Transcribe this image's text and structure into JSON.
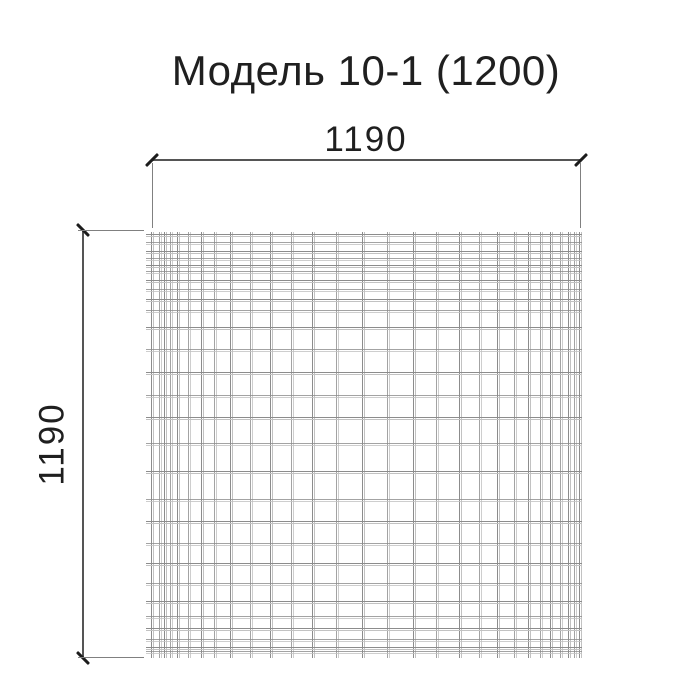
{
  "title": "Модель 10-1 (1200)",
  "dimensions": {
    "width": {
      "label": "1190"
    },
    "height": {
      "label": "1190"
    }
  },
  "mesh": {
    "vertical_wires": [
      0,
      0.018,
      0.03,
      0.044,
      0.06,
      0.086,
      0.116,
      0.148,
      0.185,
      0.231,
      0.278,
      0.326,
      0.377,
      0.433,
      0.493,
      0.551,
      0.611,
      0.667,
      0.72,
      0.766,
      0.808,
      0.847,
      0.88,
      0.91,
      0.933,
      0.956,
      0.975,
      0.988,
      1
    ],
    "horizontal_wires": [
      0,
      0.019,
      0.04,
      0.058,
      0.075,
      0.089,
      0.11,
      0.133,
      0.157,
      0.182,
      0.222,
      0.276,
      0.332,
      0.386,
      0.439,
      0.502,
      0.568,
      0.636,
      0.689,
      0.741,
      0.79,
      0.836,
      0.881,
      0.916,
      0.946,
      0.972,
      0.991,
      1
    ]
  },
  "colors": {
    "background": "#ffffff",
    "text": "#1f1f1f",
    "dimension_line": "#555555",
    "extension_line": "#808080",
    "tick": "#1c1c1c",
    "wire_dark": "#8c8c8c",
    "wire_light": "#c2c2c2"
  }
}
